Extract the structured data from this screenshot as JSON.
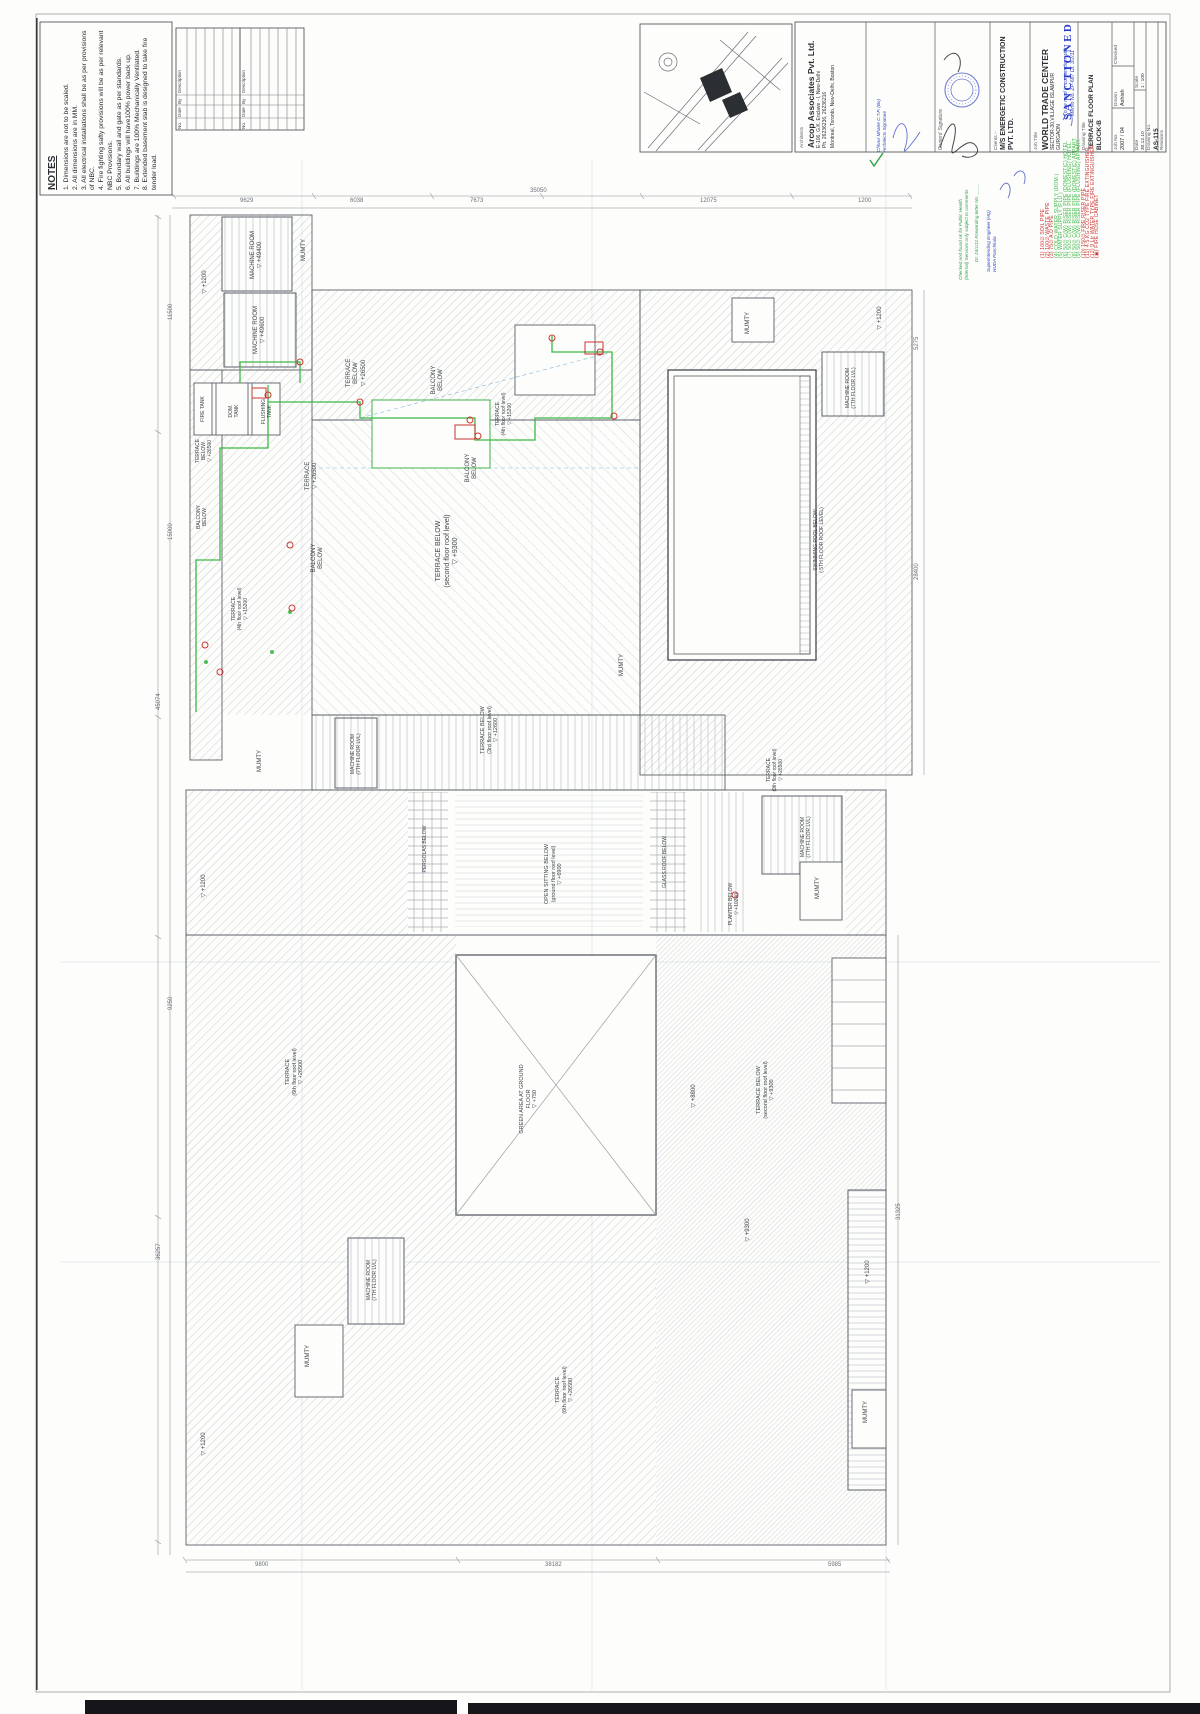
{
  "meta": {
    "accent_green": "#3cb945",
    "accent_red": "#cc3333",
    "ink_blue": "#2f45c4",
    "ink_green": "#2fa04a",
    "sanction_blue": "#2838cc"
  },
  "notes": {
    "title": "NOTES",
    "lines": [
      "1. Dimensions are not to be scaled.",
      "2. All dimensions are in MM.",
      "3. All electrical installations shall be as per provisions of NBC.",
      "4. Fire fighting safty provisions will be as per relevant NBC Provisions.",
      "5. Boundary wall and gate as per standards.",
      "6. All buildings will have100% power back up.",
      "7. Buildings are 100% Mechanically Ventilated.",
      "8. Extended basement slab is designed to take fire tender load."
    ]
  },
  "revision_table": {
    "headers": [
      "Description",
      "By",
      "Date",
      "No."
    ]
  },
  "title_block": {
    "architects_label": "Architects",
    "architects_name": "Arcop Associates Pvt. Ltd.",
    "architects_addr": "E-106, G.K. Enclave - I, New-Delhi",
    "architects_ph": "Ph. 26236236, 26236216",
    "architects_cities": "Montreal, Toronto, New-Delhi, Boston",
    "owners_label": "Owners' Signature",
    "clients_label": "Clients :-",
    "clients_line1": "M/S ENERGETIC CONSTRUCTION",
    "clients_line2": "PVT. LTD.",
    "job_title_label": "Job Title",
    "job_title": "WORLD TRADE CENTER",
    "job_addr1": "SECTOR-30,VILLAGE ISLAMPUR",
    "job_addr2": "GURGAON",
    "drawing_title_label": "Drawing Title",
    "drawing_title1": "TERRACE FLOOR PLAN",
    "drawing_title2": "BLOCK-B",
    "job_no_label": "Job No.",
    "job_no": "2007 / 04",
    "drawn_label": "Drawn",
    "drawn": "Ashish",
    "checked_label": "Checked",
    "checked": "",
    "date_label": "Date",
    "date": "30.12.10",
    "scale_label": "Scale",
    "scale": "1 : 100",
    "drawing_no_label": "Drawing No.",
    "drawing_no": "AS-115",
    "revisions_label": "Revisions"
  },
  "stamps": {
    "sanctioned": "SANCTIONED",
    "memo_line1": "To be read in conjunction with",
    "memo_line2": "Memo No. ZP-687  Dt. 3/2/11",
    "ph_check_1": "Checked and found ok for Public Health",
    "ph_check_2": "(Internal) Services only subject to comments",
    "ph_check_3": "Dt. 24/1/11  Forwarding letter No. ____",
    "se_line1": "Superintending Engineer (HQ)",
    "se_line2": "HUDA Panchkula",
    "architect_sig1": "Chhavi Mhatre  C.T.P. (Bo)",
    "architect_sig2": "Architects Signature"
  },
  "legend": {
    "rows": [
      {
        "sym": "1",
        "color": "#cc3333",
        "label": "100∅ SOIL PIPE"
      },
      {
        "sym": "2",
        "color": "#cc3333",
        "label": "100∅ WASTE PIPE"
      },
      {
        "sym": "3",
        "color": "#cc3333",
        "label": "75∅ A.D PIPE"
      },
      {
        "sym": "4",
        "color": "#3cb945",
        "label": "COLD WATER SUPPLY (DOM.)"
      },
      {
        "sym": "5",
        "color": "#3cb945",
        "label": "WATER SUPPLY (FLU.)"
      },
      {
        "sym": "6",
        "color": "#3cb945",
        "label": "50∅ C(W) RISER PIPE (DOMESTIC) HOTEL"
      },
      {
        "sym": "7",
        "color": "#3cb945",
        "label": "50∅ C(W) RISER PIPE (FLUSHING) HOTEL"
      },
      {
        "sym": "8",
        "color": "#3cb945",
        "label": "50∅ C(W) RISER PIPE (DOMESTIC) APPART."
      },
      {
        "sym": "9",
        "color": "#3cb945",
        "label": "50∅ C(W) RISER PIPE (FLUSHING) APPART."
      },
      {
        "sym": "10",
        "color": "#cc3333",
        "label": "150∅ FIRE RISER PIPE"
      },
      {
        "sym": "11",
        "color": "#cc3333",
        "label": "4.5 KG CO2 TYPE FIRE EXTINGUISHER"
      },
      {
        "sym": "12",
        "color": "#cc3333",
        "label": "9 Ltr WATER TYPE FIRE EXTINGUISHER"
      },
      {
        "sym": "▣",
        "color": "#cc3333",
        "label": "FIRE HOSE CABINET"
      }
    ]
  },
  "plan": {
    "labels": [
      {
        "n": "machine-room-label",
        "x": 228,
        "y": 224,
        "w": 58,
        "h": 62,
        "lines": [
          "MACHINE ROOM",
          "+49400"
        ]
      },
      {
        "n": "level-label",
        "x": 196,
        "y": 260,
        "w": 20,
        "h": 44,
        "lines": [
          "+1200"
        ]
      },
      {
        "n": "mumty-label",
        "x": 298,
        "y": 232,
        "w": 13,
        "h": 36,
        "lines": [
          "MUMTY"
        ]
      },
      {
        "n": "machine-room-label",
        "x": 232,
        "y": 300,
        "w": 56,
        "h": 60,
        "lines": [
          "MACHINE ROOM",
          "+49600"
        ]
      },
      {
        "n": "terrace-label",
        "x": 342,
        "y": 348,
        "w": 30,
        "h": 50,
        "lines": [
          "TERRACE BELOW",
          "+26500"
        ]
      },
      {
        "n": "balcony-label",
        "x": 428,
        "y": 358,
        "w": 20,
        "h": 44,
        "lines": [
          "BALCONY",
          "BELOW"
        ]
      },
      {
        "n": "fire-tank-label",
        "x": 196,
        "y": 386,
        "w": 13,
        "h": 46,
        "lines": [
          "FIRE TANK"
        ],
        "s": 5
      },
      {
        "n": "dom-tank-label",
        "x": 221,
        "y": 388,
        "w": 26,
        "h": 46,
        "lines": [
          "DOM.",
          "TANK"
        ],
        "s": 5
      },
      {
        "n": "flushing-tank-label",
        "x": 256,
        "y": 388,
        "w": 22,
        "h": 47,
        "lines": [
          "FLUSHING",
          "TANK"
        ],
        "s": 5
      },
      {
        "n": "terrace-label",
        "x": 490,
        "y": 386,
        "w": 28,
        "h": 56,
        "lines": [
          "TERRACE",
          "(4th floor roof level)",
          "+15200"
        ],
        "s": 5
      },
      {
        "n": "terrace-label",
        "x": 193,
        "y": 425,
        "w": 22,
        "h": 52,
        "lines": [
          "TERRACE",
          "BELOW",
          "+26500"
        ],
        "s": 5
      },
      {
        "n": "balcony-label",
        "x": 462,
        "y": 446,
        "w": 20,
        "h": 44,
        "lines": [
          "BALCONY",
          "BELOW"
        ]
      },
      {
        "n": "terrace-label",
        "x": 300,
        "y": 452,
        "w": 24,
        "h": 48,
        "lines": [
          "TERRACE",
          "+26500"
        ]
      },
      {
        "n": "balcony-label",
        "x": 193,
        "y": 496,
        "w": 18,
        "h": 42,
        "lines": [
          "BALCONY",
          "BELOW"
        ],
        "s": 5
      },
      {
        "n": "terrace-label",
        "x": 430,
        "y": 512,
        "w": 36,
        "h": 78,
        "lines": [
          "TERRACE  BELOW",
          "(second floor roof level)",
          "+9300"
        ],
        "s": 7
      },
      {
        "n": "balcony-label",
        "x": 308,
        "y": 536,
        "w": 20,
        "h": 44,
        "lines": [
          "BALCONY",
          "BELOW"
        ]
      },
      {
        "n": "terrace-label",
        "x": 226,
        "y": 580,
        "w": 28,
        "h": 58,
        "lines": [
          "TERRACE",
          "(4th floor roof level)",
          "+15200"
        ],
        "s": 5
      },
      {
        "n": "swimming-pool-label",
        "x": 808,
        "y": 502,
        "w": 22,
        "h": 76,
        "lines": [
          "SWIMMING POOL BELOW",
          "( 5TH FLOOR ROOF LEVEL)"
        ],
        "s": 5
      },
      {
        "n": "mumty-label",
        "x": 742,
        "y": 304,
        "w": 14,
        "h": 38,
        "lines": [
          "MUMTY"
        ]
      },
      {
        "n": "machine-room-label",
        "x": 830,
        "y": 360,
        "w": 42,
        "h": 56,
        "lines": [
          "MACHINE ROOM",
          "(7TH FLOOR LVL)"
        ],
        "s": 5
      },
      {
        "n": "level-label",
        "x": 872,
        "y": 298,
        "w": 18,
        "h": 40,
        "lines": [
          "+1200"
        ]
      },
      {
        "n": "mumty-label",
        "x": 616,
        "y": 646,
        "w": 14,
        "h": 38,
        "lines": [
          "MUMTY"
        ]
      },
      {
        "n": "terrace-label",
        "x": 474,
        "y": 698,
        "w": 32,
        "h": 64,
        "lines": [
          "TERRACE BELOW",
          "(3rd floor roof level)",
          "+12600"
        ],
        "s": 5.5
      },
      {
        "n": "machine-room-label",
        "x": 340,
        "y": 722,
        "w": 32,
        "h": 64,
        "lines": [
          "MACHINE ROOM",
          "(7TH FLOOR LVL)"
        ],
        "s": 5
      },
      {
        "n": "mumty-label",
        "x": 254,
        "y": 742,
        "w": 14,
        "h": 38,
        "lines": [
          "MUMTY"
        ]
      },
      {
        "n": "terrace-label",
        "x": 760,
        "y": 740,
        "w": 30,
        "h": 60,
        "lines": [
          "TERRACE",
          "(9th floor roof level)",
          "+26500"
        ],
        "s": 5
      },
      {
        "n": "machine-room-label",
        "x": 788,
        "y": 806,
        "w": 36,
        "h": 62,
        "lines": [
          "MACHINE ROOM",
          "(7TH FLOOR LVL)"
        ],
        "s": 5
      },
      {
        "n": "mumty-label",
        "x": 812,
        "y": 868,
        "w": 14,
        "h": 40,
        "lines": [
          "MUMTY"
        ]
      },
      {
        "n": "level-label",
        "x": 196,
        "y": 866,
        "w": 18,
        "h": 40,
        "lines": [
          "+1200"
        ]
      },
      {
        "n": "pergolas-label",
        "x": 418,
        "y": 818,
        "w": 14,
        "h": 62,
        "lines": [
          "PERGOLAS BELOW"
        ],
        "s": 5
      },
      {
        "n": "open-sitting-label",
        "x": 538,
        "y": 840,
        "w": 32,
        "h": 68,
        "lines": [
          "OPEN SITTING BELOW",
          "(ground floor roof level)",
          "+6900"
        ],
        "s": 5.5
      },
      {
        "n": "glass-roof-label",
        "x": 658,
        "y": 830,
        "w": 14,
        "h": 64,
        "lines": [
          "GLASS ROOF BELOW"
        ],
        "s": 5
      },
      {
        "n": "planter-label",
        "x": 722,
        "y": 876,
        "w": 24,
        "h": 56,
        "lines": [
          "PLANTER BELOW",
          "+10200"
        ],
        "s": 5
      },
      {
        "n": "terrace-label",
        "x": 280,
        "y": 1040,
        "w": 30,
        "h": 64,
        "lines": [
          "TERRACE",
          "(6th floor roof level)",
          "+26500"
        ],
        "s": 5.5
      },
      {
        "n": "green-area-label",
        "x": 514,
        "y": 1060,
        "w": 30,
        "h": 78,
        "lines": [
          "GREEN AREA AT GROUND FLOOR",
          "+750"
        ],
        "s": 5.5
      },
      {
        "n": "level-label",
        "x": 686,
        "y": 1076,
        "w": 18,
        "h": 40,
        "lines": [
          "+8800"
        ]
      },
      {
        "n": "terrace-label",
        "x": 750,
        "y": 1056,
        "w": 32,
        "h": 68,
        "lines": [
          "TERRACE  BELOW",
          "(second floor roof level)",
          "+9300"
        ],
        "s": 5.5
      },
      {
        "n": "level-label",
        "x": 740,
        "y": 1210,
        "w": 18,
        "h": 40,
        "lines": [
          "+9300"
        ]
      },
      {
        "n": "machine-room-label",
        "x": 354,
        "y": 1246,
        "w": 36,
        "h": 68,
        "lines": [
          "MACHINE ROOM",
          "(7TH FLOOR LVL)"
        ],
        "s": 5
      },
      {
        "n": "mumty-label",
        "x": 302,
        "y": 1336,
        "w": 14,
        "h": 40,
        "lines": [
          "MUMTY"
        ]
      },
      {
        "n": "level-label",
        "x": 860,
        "y": 1252,
        "w": 18,
        "h": 40,
        "lines": [
          "+1200"
        ]
      },
      {
        "n": "terrace-label",
        "x": 550,
        "y": 1358,
        "w": 30,
        "h": 64,
        "lines": [
          "TERRACE",
          "(6th floor roof level)",
          "+26500"
        ],
        "s": 5.5
      },
      {
        "n": "mumty-label",
        "x": 860,
        "y": 1392,
        "w": 14,
        "h": 40,
        "lines": [
          "MUMTY"
        ]
      },
      {
        "n": "level-label",
        "x": 196,
        "y": 1424,
        "w": 18,
        "h": 40,
        "lines": [
          "+1200"
        ]
      }
    ],
    "dims": [
      {
        "t": "35050",
        "x": 530,
        "y": 188,
        "r": 0
      },
      {
        "t": "9629",
        "x": 240,
        "y": 198,
        "r": 0
      },
      {
        "t": "6038",
        "x": 350,
        "y": 198,
        "r": 0
      },
      {
        "t": "7673",
        "x": 470,
        "y": 198,
        "r": 0
      },
      {
        "t": "12075",
        "x": 700,
        "y": 198,
        "r": 0
      },
      {
        "t": "1200",
        "x": 858,
        "y": 198,
        "r": 0
      },
      {
        "t": "45074",
        "x": 156,
        "y": 710,
        "r": -90
      },
      {
        "t": "11500",
        "x": 168,
        "y": 320,
        "r": -90
      },
      {
        "t": "15000",
        "x": 168,
        "y": 540,
        "r": -90
      },
      {
        "t": "9250",
        "x": 168,
        "y": 1010,
        "r": -90
      },
      {
        "t": "36257",
        "x": 156,
        "y": 1260,
        "r": -90
      },
      {
        "t": "5275",
        "x": 914,
        "y": 350,
        "r": -90
      },
      {
        "t": "28400",
        "x": 914,
        "y": 580,
        "r": -90
      },
      {
        "t": "31325",
        "x": 896,
        "y": 1220,
        "r": -90
      },
      {
        "t": "9800",
        "x": 255,
        "y": 1562,
        "r": 0
      },
      {
        "t": "38182",
        "x": 545,
        "y": 1562,
        "r": 0
      },
      {
        "t": "5985",
        "x": 828,
        "y": 1562,
        "r": 0
      }
    ]
  }
}
